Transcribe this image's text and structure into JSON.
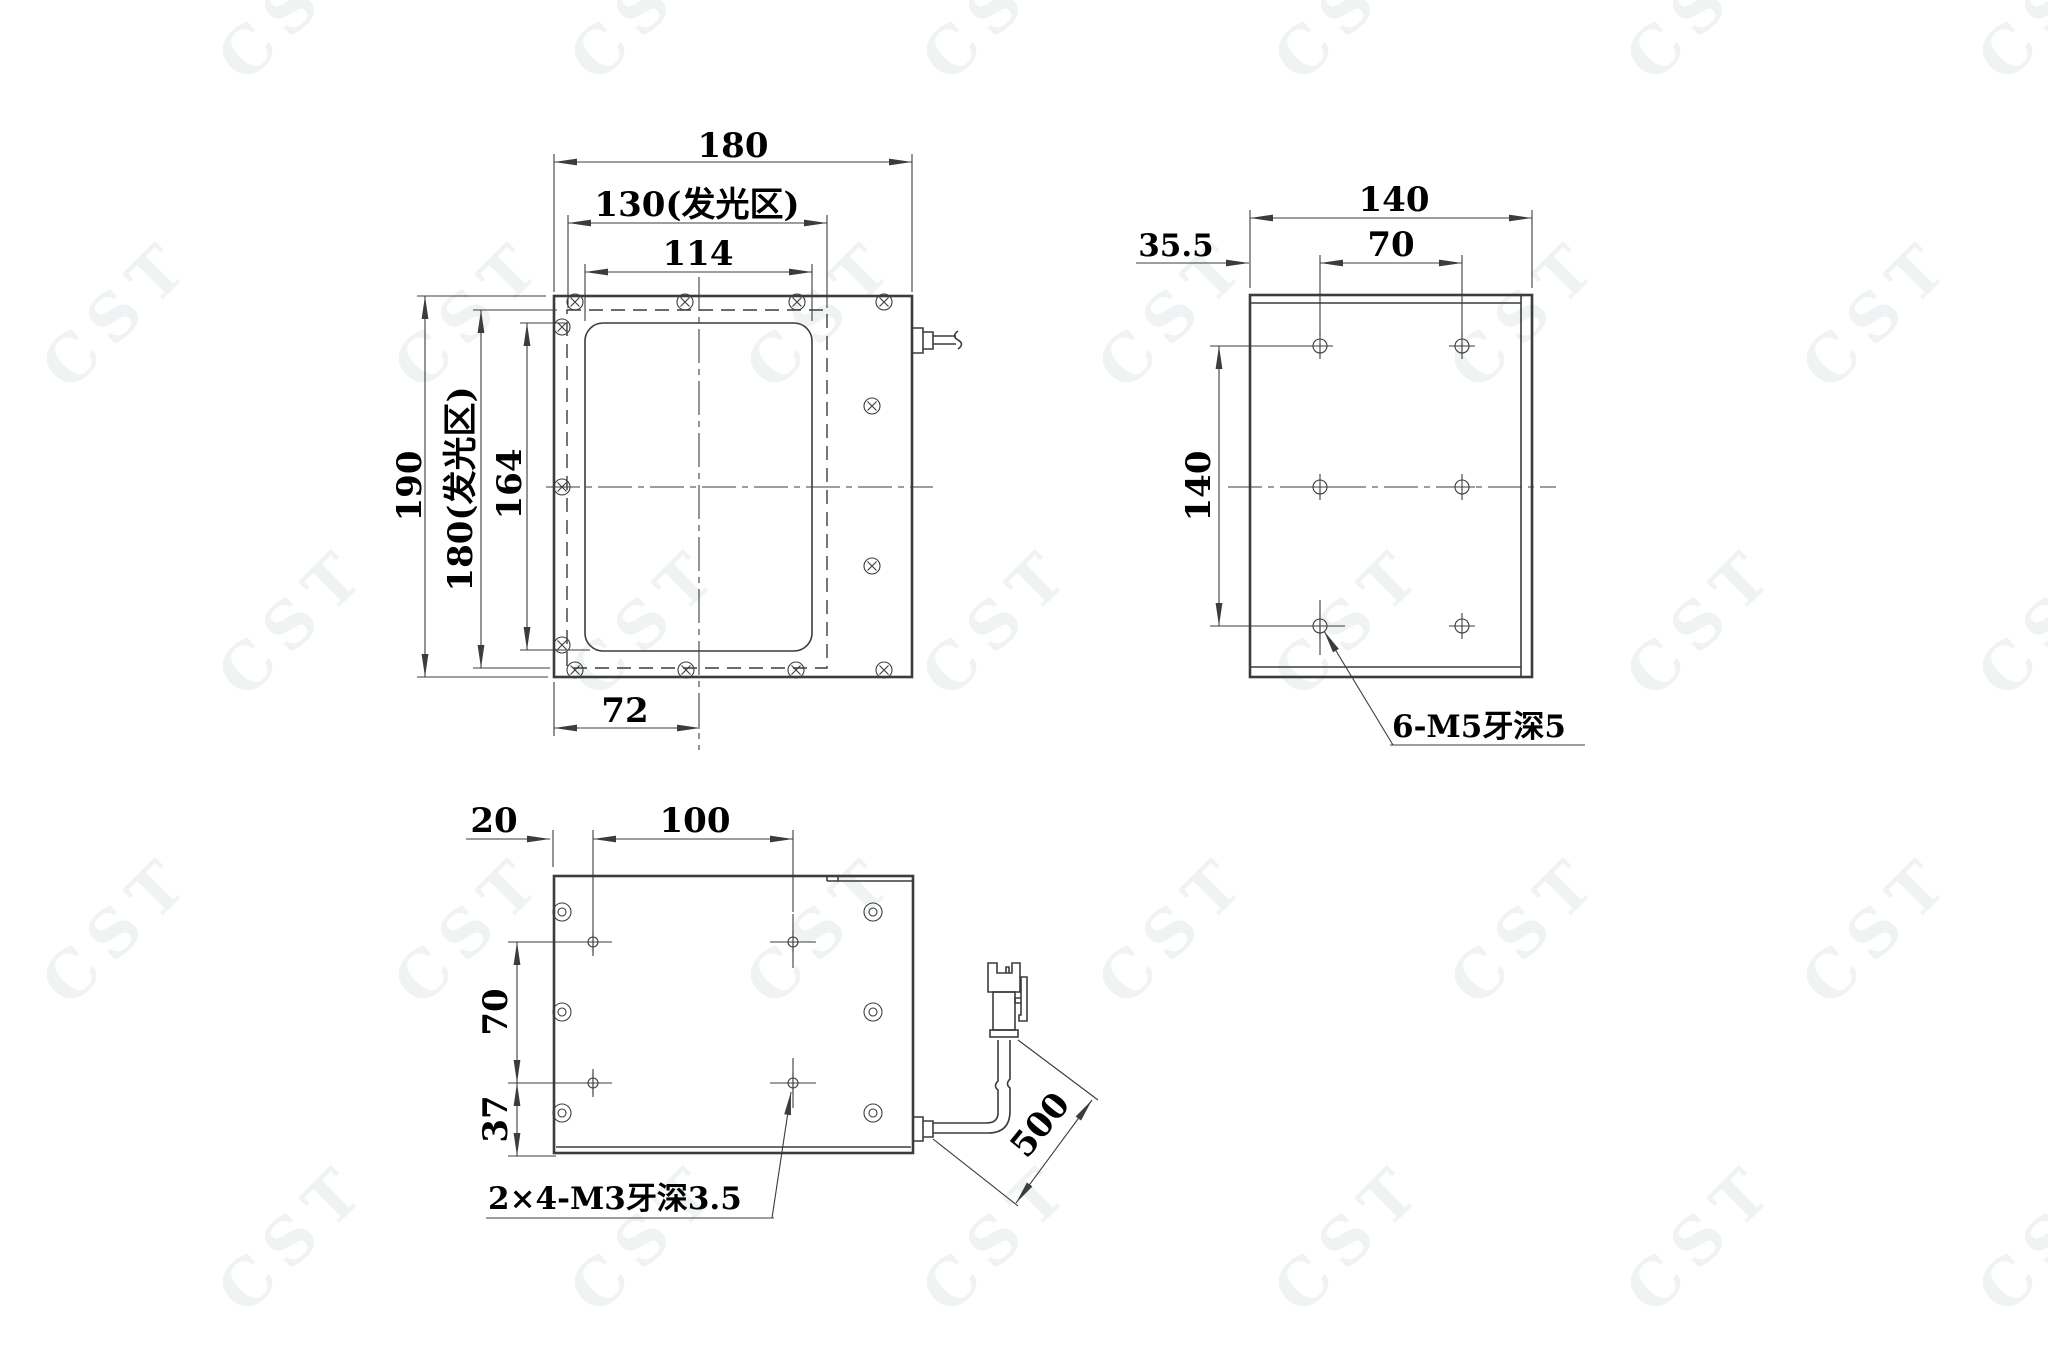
{
  "watermark": {
    "text": "CST"
  },
  "colors": {
    "line": "#3c3c3c",
    "text": "#000000",
    "watermark": "#eff3f3",
    "background": "#ffffff"
  },
  "front_view": {
    "dim_width_total": "180",
    "dim_width_light_area": "130(发光区)",
    "dim_width_window": "114",
    "dim_height_total": "190",
    "dim_height_light_area": "180(发光区)",
    "dim_height_window": "164",
    "dim_center_offset": "72"
  },
  "side_view": {
    "dim_depth": "140",
    "dim_first_hole_offset": "35.5",
    "dim_hole_pitch_horizontal": "70",
    "dim_hole_pitch_vertical": "140",
    "thread_note": "6-M5牙深5"
  },
  "back_view": {
    "dim_edge_to_hole": "20",
    "dim_hole_pitch_horizontal": "100",
    "dim_hole_pitch_vertical": "70",
    "dim_hole_to_bottom": "37",
    "dim_cable_length": "500",
    "thread_note": "2×4-M3牙深3.5"
  }
}
